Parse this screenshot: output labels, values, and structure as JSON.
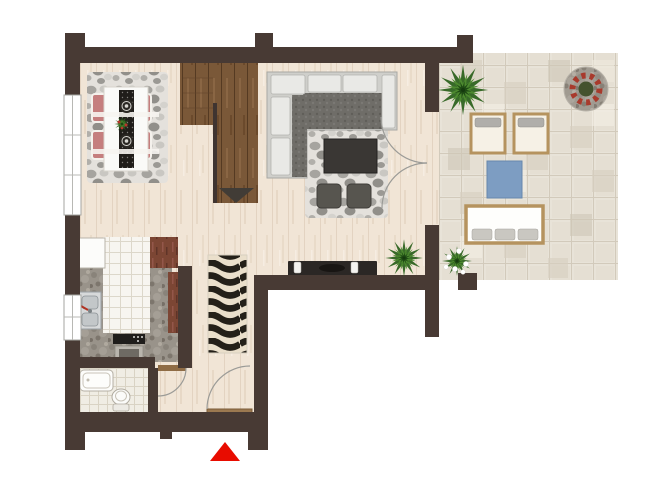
{
  "scene": {
    "kind": "apartment-floor-plan",
    "marker": {
      "shape": "triangle-up",
      "color": "#e80c00",
      "position": "below-entry-door"
    }
  },
  "colors": {
    "wall": "#483a34",
    "floor": "#f1e5d6",
    "stairs": "#7a5838",
    "terrace": "#e8e3d8",
    "kitchen_tile": "#f7f5f0",
    "granite": "#99938a",
    "cabinet": "#7c4634",
    "rug": "#e4e1dc",
    "sofa": "#cfcfcb",
    "sofa_seat": "#6f6d68",
    "chair": "#c57e7e",
    "runner": "#201d1a",
    "tv": "#2b2725",
    "plant": "#2e6320",
    "mat_blue": "#7d9dc2",
    "trim_wood": "#b5935f",
    "marker": "#e80c00",
    "window": "#ffffff"
  },
  "elements": [
    "dining-rug",
    "dining-table",
    "table-runner",
    "dining-chairs",
    "plates",
    "staircase",
    "stair-direction-triangle",
    "corner-sofa",
    "living-rug",
    "coffee-table",
    "ottomans",
    "tv-console",
    "candles",
    "kitchen-tile-floor",
    "granite-counter",
    "sink",
    "stove",
    "fridge",
    "cabinets",
    "bathroom",
    "bathtub",
    "toilet",
    "hallway-wave-rug",
    "bathroom-door",
    "entry-door",
    "terrace-doors",
    "terrace-stone-floor",
    "sun-lounger",
    "sun-lounger",
    "blue-mat",
    "garden-bench",
    "mosaic-table",
    "palm-plant",
    "palm-plant",
    "flowering-plant",
    "table-centerpiece",
    "entrance-marker"
  ]
}
